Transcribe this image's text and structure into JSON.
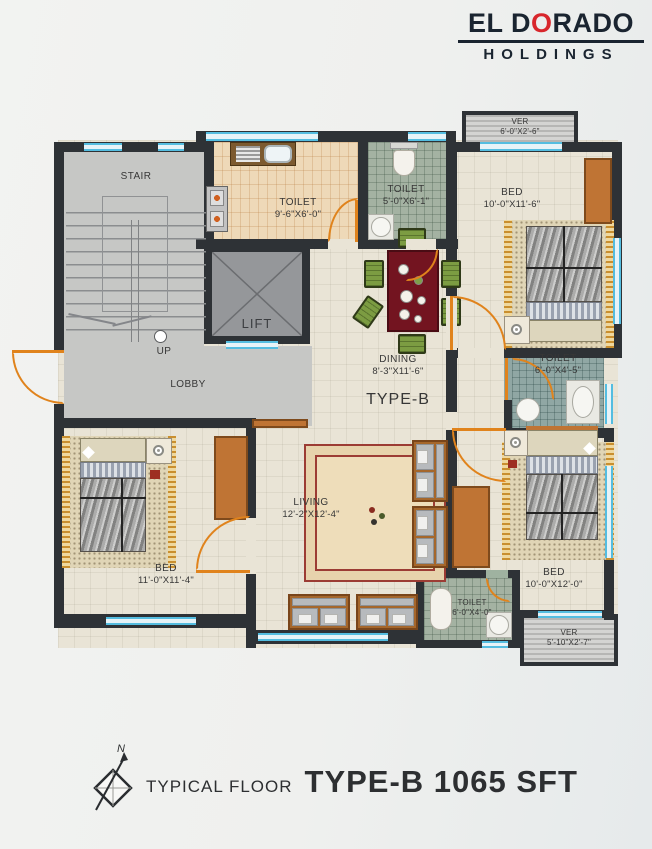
{
  "logo": {
    "name_prefix": "EL D",
    "name_accent": "O",
    "name_suffix": "RADO",
    "subtitle": "HOLDINGS"
  },
  "plan": {
    "type_label": "TYPE-B",
    "stair": {
      "label": "STAIR",
      "up": "UP"
    },
    "lift": {
      "label": "LIFT"
    },
    "lobby": {
      "label": "LOBBY"
    },
    "kitchen": {
      "label": "TOILET",
      "dims": "9'-6\"X6'-0\""
    },
    "toilet_top": {
      "label": "TOILET",
      "dims": "5'-0\"X6'-1\""
    },
    "ver_top": {
      "label": "VER",
      "dims": "6'-0\"X2'-6\""
    },
    "bed_top_right": {
      "label": "BED",
      "dims": "10'-0\"X11'-6\""
    },
    "dining": {
      "label": "DINING",
      "dims": "8'-3\"X11'-6\""
    },
    "toilet_mid": {
      "label": "TOILET",
      "dims": "6'-0\"X4'-5\""
    },
    "living": {
      "label": "LIVING",
      "dims": "12'-2\"X12'-4\""
    },
    "bed_bottom_left": {
      "label": "BED",
      "dims": "11'-0\"X11'-4\""
    },
    "bed_bottom_right": {
      "label": "BED",
      "dims": "10'-0\"X12'-0\""
    },
    "toilet_bottom": {
      "label": "TOILET",
      "dims": "6'-0\"X4'-0\""
    },
    "ver_bottom": {
      "label": "VER",
      "dims": "5'-10\"X2'-7\""
    }
  },
  "footer": {
    "floor_label": "TYPICAL FLOOR",
    "title": "TYPE-B 1065 SFT",
    "north": "N"
  },
  "colors": {
    "wall": "#2e3236",
    "window": "#54bde0",
    "door": "#e0831c",
    "wood": "#bf7434",
    "logo_red": "#d8262c",
    "logo_dark": "#1a2430",
    "floor": "#e9e4d6",
    "floor_gray": "#c6c7c5",
    "kitchen_tile": "#eed9b8",
    "toilet_tile_green": "#a4b2a2",
    "toilet_tile_teal": "#90a7a4",
    "table_red": "#731420",
    "chair_green": "#7c9c42"
  }
}
